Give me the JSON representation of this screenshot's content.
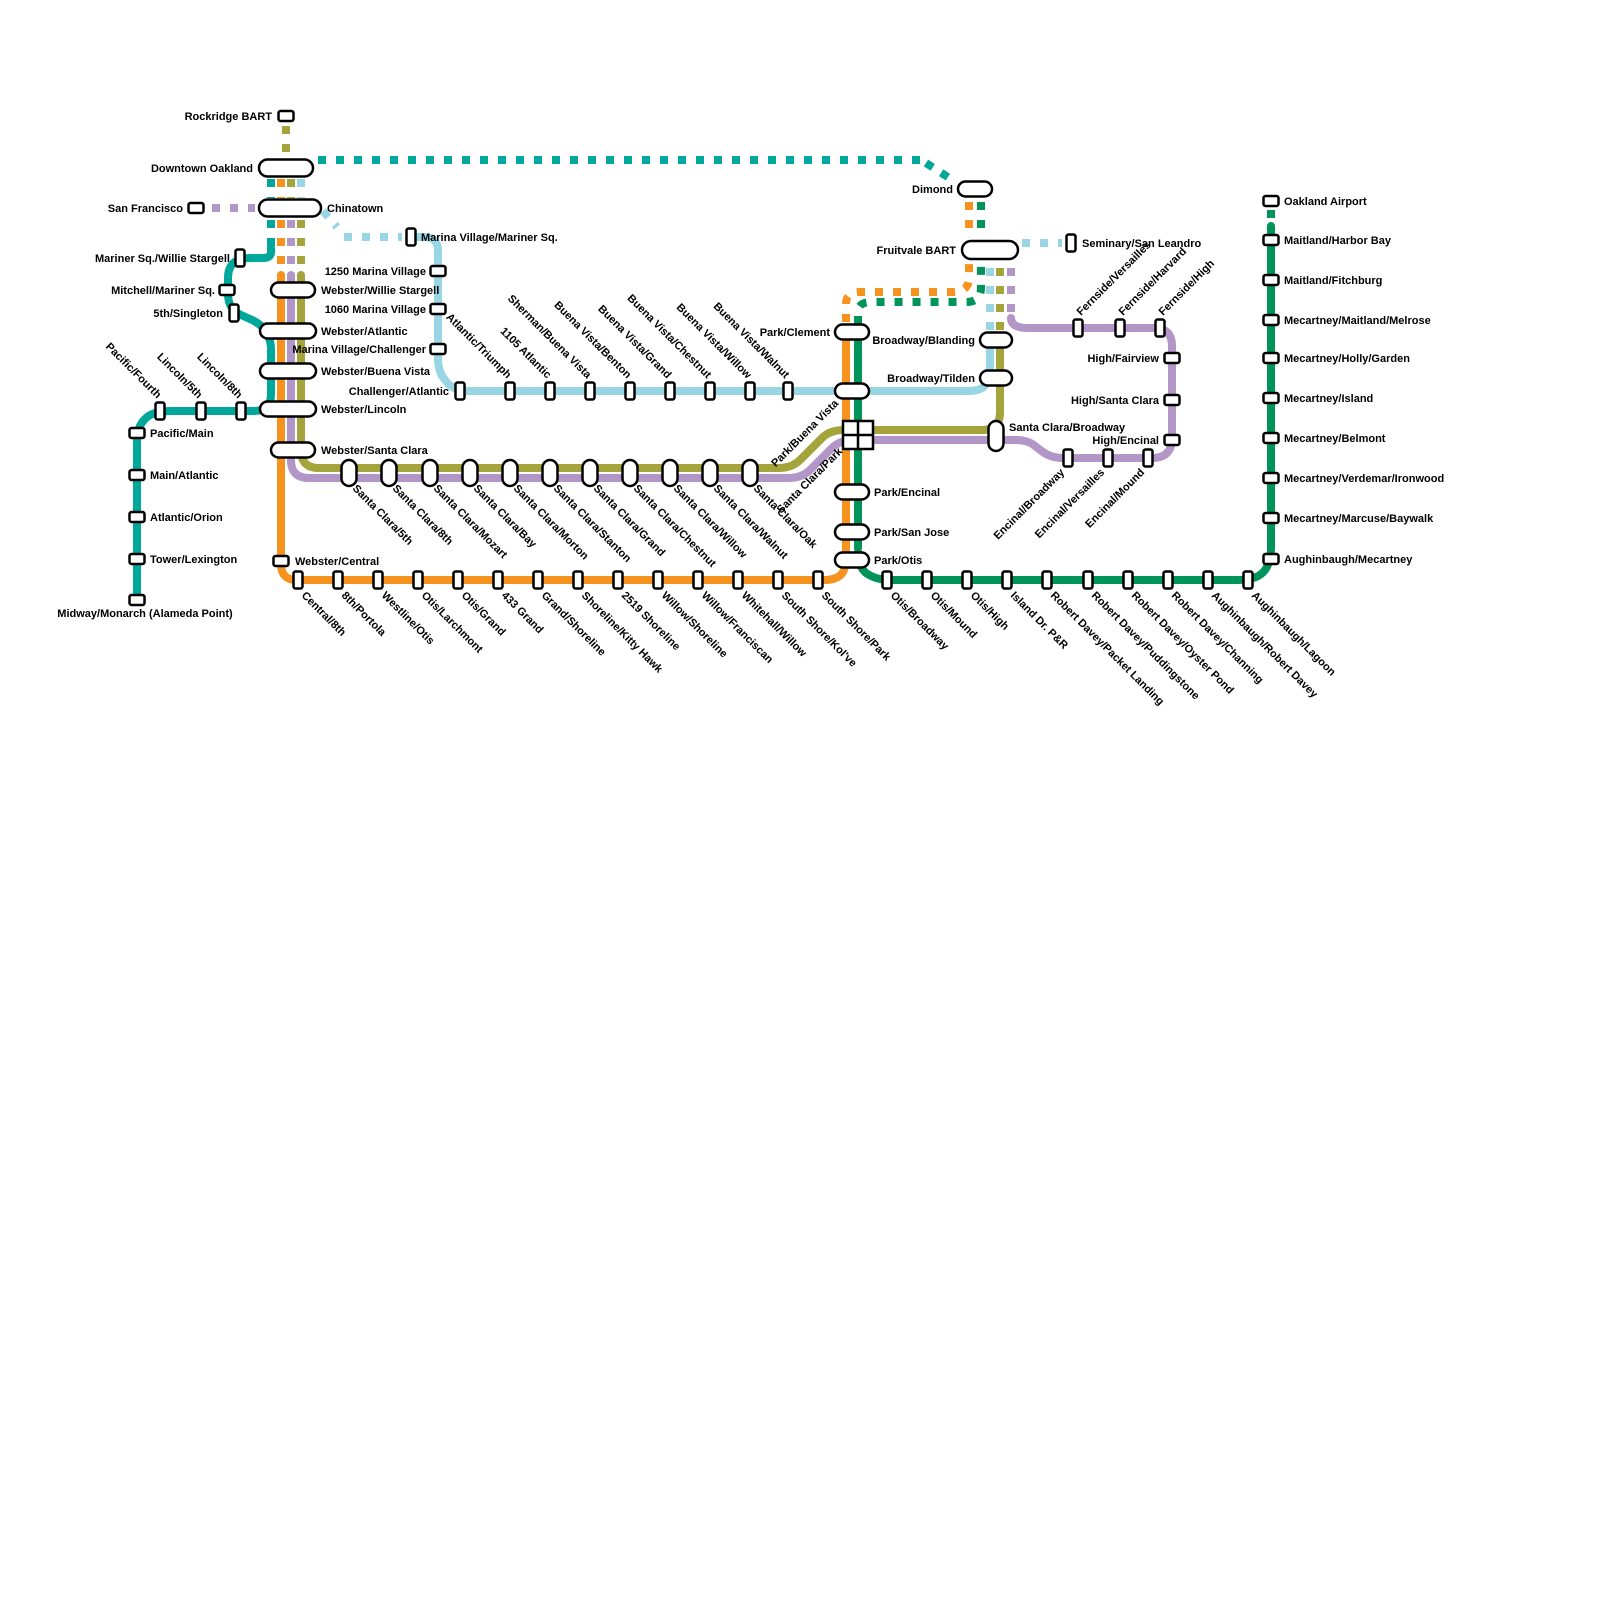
{
  "map": {
    "background": "#ffffff",
    "colors": {
      "teal": "#00a89c",
      "orange": "#f6921e",
      "lightblue": "#98d6e4",
      "olive": "#a4a33c",
      "purple": "#b296c7",
      "green": "#00945a"
    },
    "segments": [
      {
        "c": "teal",
        "d": false,
        "p": "M 271 248 V 252 Q 271 258 263 258 H 250 Q 228 258 228 278 V 294 Q 228 309 241 315 L 250 319 Q 271 328 271 350 V 394 Q 271 411 254 411 H 172 Q 152 411 145 419 Q 137 427 137 440 V 598"
      },
      {
        "c": "teal",
        "d": true,
        "p": "M 271 179 V 198"
      },
      {
        "c": "teal",
        "d": true,
        "p": "M 271 220 V 246"
      },
      {
        "c": "teal",
        "d": true,
        "p": "M 318 160 H 920"
      },
      {
        "c": "teal",
        "d": true,
        "p": "M 926 163 L 954 181"
      },
      {
        "c": "orange",
        "d": false,
        "p": "M 281 275 V 564 Q 281 580 297 580 H 824 Q 840 580 844 570 Q 846 564 846 548 V 330"
      },
      {
        "c": "orange",
        "d": true,
        "p": "M 281 179 V 198"
      },
      {
        "c": "orange",
        "d": true,
        "p": "M 281 220 V 276"
      },
      {
        "c": "orange",
        "d": true,
        "p": "M 846 322 V 304 Q 846 292 860 292 H 952 Q 969 292 969 278 V 262"
      },
      {
        "c": "orange",
        "d": true,
        "p": "M 969 202 V 236"
      },
      {
        "c": "green",
        "d": false,
        "p": "M 858 548 V 330"
      },
      {
        "c": "green",
        "d": false,
        "p": "M 858 552 Q 858 566 866 573 Q 876 580 890 580 H 1238 Q 1258 580 1265 570 Q 1271 562 1271 548 V 226"
      },
      {
        "c": "green",
        "d": true,
        "p": "M 858 324 V 312 Q 858 302 872 302 H 966 Q 981 302 981 288 V 262"
      },
      {
        "c": "green",
        "d": true,
        "p": "M 981 202 V 236"
      },
      {
        "c": "green",
        "d": true,
        "p": "M 1271 210 V 224"
      },
      {
        "c": "lightblue",
        "d": false,
        "p": "M 412 237 H 424 Q 438 237 438 251 V 358 Q 438 372 445 380 Q 453 391 467 391 H 968 Q 982 391 986 384 Q 990 378 990 368 V 336"
      },
      {
        "c": "lightblue",
        "d": true,
        "p": "M 990 330 V 262"
      },
      {
        "c": "lightblue",
        "d": true,
        "p": "M 1022 243 H 1062"
      },
      {
        "c": "lightblue",
        "d": true,
        "p": "M 301 179 V 198"
      },
      {
        "c": "lightblue",
        "d": true,
        "p": "M 323 211 L 337 227"
      },
      {
        "c": "lightblue",
        "d": true,
        "p": "M 344 237 H 402"
      },
      {
        "c": "olive",
        "d": false,
        "p": "M 301 275 V 450 Q 301 468 319 468 H 778 Q 792 468 800 460 L 822 438 Q 830 430 844 430 H 982 Q 1000 430 1000 412 V 336"
      },
      {
        "c": "olive",
        "d": true,
        "p": "M 1000 330 V 262"
      },
      {
        "c": "olive",
        "d": true,
        "p": "M 286 126 V 152"
      },
      {
        "c": "olive",
        "d": true,
        "p": "M 291 179 V 198"
      },
      {
        "c": "olive",
        "d": true,
        "p": "M 301 220 V 276"
      },
      {
        "c": "purple",
        "d": false,
        "p": "M 291 275 V 460 Q 291 478 309 478 H 788 Q 802 478 810 470 L 832 448 Q 840 440 854 440 H 1016 Q 1028 440 1035 446 L 1043 452 Q 1051 458 1064 458 H 1152 Q 1172 458 1172 438 V 346 Q 1172 328 1154 328 H 1028 Q 1011 328 1011 318"
      },
      {
        "c": "purple",
        "d": true,
        "p": "M 1011 312 V 262"
      },
      {
        "c": "purple",
        "d": true,
        "p": "M 212 208 H 255"
      },
      {
        "c": "purple",
        "d": true,
        "p": "M 291 220 V 276"
      }
    ],
    "stations": [
      {
        "label": "Rockridge BART",
        "x": 286,
        "y": 116,
        "m": "rh",
        "lp": "left",
        "ld": 14
      },
      {
        "label": "Downtown Oakland",
        "x": 286,
        "y": 168,
        "m": "ph",
        "w": 54,
        "h": 17,
        "lp": "left",
        "ld": 33
      },
      {
        "label": "San Francisco",
        "x": 196,
        "y": 208,
        "m": "rh",
        "lp": "left",
        "ld": 13
      },
      {
        "label": "Chinatown",
        "x": 290,
        "y": 208,
        "m": "ph",
        "w": 62,
        "h": 17,
        "lp": "right",
        "ld": 37
      },
      {
        "label": "Marina Village/Mariner Sq.",
        "x": 411,
        "y": 237,
        "m": "rv",
        "lp": "right",
        "ld": 10
      },
      {
        "label": "Mariner Sq./Willie Stargell",
        "x": 240,
        "y": 258,
        "m": "rv",
        "lp": "left",
        "ld": 10
      },
      {
        "label": "1250 Marina Village",
        "x": 438,
        "y": 271,
        "m": "rh",
        "lp": "left",
        "ld": 12
      },
      {
        "label": "Mitchell/Mariner Sq.",
        "x": 227,
        "y": 290,
        "m": "rh",
        "lp": "left",
        "ld": 12
      },
      {
        "label": "Webster/Willie Stargell",
        "x": 293,
        "y": 290,
        "m": "ph",
        "w": 44,
        "lp": "right",
        "ld": 28
      },
      {
        "label": "1060 Marina Village",
        "x": 438,
        "y": 309,
        "m": "rh",
        "lp": "left",
        "ld": 12
      },
      {
        "label": "5th/Singleton",
        "x": 234,
        "y": 313,
        "m": "rv",
        "lp": "left",
        "ld": 11
      },
      {
        "label": "Webster/Atlantic",
        "x": 288,
        "y": 331,
        "m": "ph",
        "w": 56,
        "lp": "right",
        "ld": 33
      },
      {
        "label": "Marina Village/Challenger",
        "x": 438,
        "y": 349,
        "m": "rh",
        "lp": "left",
        "ld": 12
      },
      {
        "label": "Webster/Buena Vista",
        "x": 288,
        "y": 371,
        "m": "ph",
        "w": 56,
        "lp": "right",
        "ld": 33
      },
      {
        "label": "Challenger/Atlantic",
        "x": 460,
        "y": 391,
        "m": "rv",
        "lp": "left",
        "ld": 11
      },
      {
        "label": "Webster/Lincoln",
        "x": 288,
        "y": 409,
        "m": "ph",
        "w": 56,
        "lp": "right",
        "ld": 33
      },
      {
        "label": "Pacific/Fourth",
        "x": 160,
        "y": 411,
        "m": "rv",
        "lp": "ul"
      },
      {
        "label": "Lincoln/5th",
        "x": 201,
        "y": 411,
        "m": "rv",
        "lp": "ul"
      },
      {
        "label": "Lincoln/8th",
        "x": 241,
        "y": 411,
        "m": "rv",
        "lp": "ul"
      },
      {
        "label": "Webster/Santa Clara",
        "x": 293,
        "y": 450,
        "m": "ph",
        "w": 44,
        "lp": "right",
        "ld": 28
      },
      {
        "label": "Pacific/Main",
        "x": 137,
        "y": 433,
        "m": "rh",
        "lp": "right",
        "ld": 13
      },
      {
        "label": "Main/Atlantic",
        "x": 137,
        "y": 475,
        "m": "rh",
        "lp": "right",
        "ld": 13
      },
      {
        "label": "Atlantic/Orion",
        "x": 137,
        "y": 517,
        "m": "rh",
        "lp": "right",
        "ld": 13
      },
      {
        "label": "Tower/Lexington",
        "x": 137,
        "y": 559,
        "m": "rh",
        "lp": "right",
        "ld": 13
      },
      {
        "label": "Midway/Monarch (Alameda Point)",
        "x": 137,
        "y": 600,
        "m": "rh",
        "lp": "below",
        "ld": 17,
        "lo": [
          8,
          0
        ]
      },
      {
        "label": "Atlantic/Triumph",
        "x": 510,
        "y": 391,
        "m": "rv",
        "lp": "ul"
      },
      {
        "label": "1105 Atlantic",
        "x": 550,
        "y": 391,
        "m": "rv",
        "lp": "ul"
      },
      {
        "label": "Sherman/Buena Vista",
        "x": 590,
        "y": 391,
        "m": "rv",
        "lp": "ul"
      },
      {
        "label": "Buena Vista/Benton",
        "x": 630,
        "y": 391,
        "m": "rv",
        "lp": "ul"
      },
      {
        "label": "Buena Vista/Grand",
        "x": 670,
        "y": 391,
        "m": "rv",
        "lp": "ul"
      },
      {
        "label": "Buena Vista/Chestnut",
        "x": 710,
        "y": 391,
        "m": "rv",
        "lp": "ul"
      },
      {
        "label": "Buena Vista/Willow",
        "x": 750,
        "y": 391,
        "m": "rv",
        "lp": "ul"
      },
      {
        "label": "Buena Vista/Walnut",
        "x": 788,
        "y": 391,
        "m": "rv",
        "lp": "ul"
      },
      {
        "label": "Park/Buena Vista",
        "x": 852,
        "y": 391,
        "m": "ph",
        "w": 34,
        "lp": "dl",
        "lo": [
          -10,
          -2
        ]
      },
      {
        "label": "Santa Clara/5th",
        "x": 349,
        "y": 473,
        "m": "pv",
        "lp": "dr"
      },
      {
        "label": "Santa Clara/8th",
        "x": 389,
        "y": 473,
        "m": "pv",
        "lp": "dr"
      },
      {
        "label": "Santa Clara/Mozart",
        "x": 430,
        "y": 473,
        "m": "pv",
        "lp": "dr"
      },
      {
        "label": "Santa Clara/Bay",
        "x": 470,
        "y": 473,
        "m": "pv",
        "lp": "dr"
      },
      {
        "label": "Santa Clara/Morton",
        "x": 510,
        "y": 473,
        "m": "pv",
        "lp": "dr"
      },
      {
        "label": "Santa Clara/Stanton",
        "x": 550,
        "y": 473,
        "m": "pv",
        "lp": "dr"
      },
      {
        "label": "Santa Clara/Grand",
        "x": 590,
        "y": 473,
        "m": "pv",
        "lp": "dr"
      },
      {
        "label": "Santa Clara/Chestnut",
        "x": 630,
        "y": 473,
        "m": "pv",
        "lp": "dr"
      },
      {
        "label": "Santa Clara/Willow",
        "x": 670,
        "y": 473,
        "m": "pv",
        "lp": "dr"
      },
      {
        "label": "Santa Clara/Walnut",
        "x": 710,
        "y": 473,
        "m": "pv",
        "lp": "dr"
      },
      {
        "label": "Santa Clara/Oak",
        "x": 750,
        "y": 473,
        "m": "pv",
        "lp": "dr"
      },
      {
        "label": "Santa Clara/Park",
        "x": 858,
        "y": 435,
        "m": "ix",
        "lp": "dl",
        "lo": [
          -12,
          2
        ]
      },
      {
        "label": "Park/Clement",
        "x": 852,
        "y": 332,
        "m": "ph",
        "w": 34,
        "lp": "left",
        "ld": 22
      },
      {
        "label": "Park/Encinal",
        "x": 852,
        "y": 492,
        "m": "ph",
        "w": 34,
        "lp": "right",
        "ld": 22
      },
      {
        "label": "Park/San Jose",
        "x": 852,
        "y": 532,
        "m": "ph",
        "w": 34,
        "lp": "right",
        "ld": 22
      },
      {
        "label": "Park/Otis",
        "x": 852,
        "y": 560,
        "m": "ph",
        "w": 34,
        "lp": "right",
        "ld": 22
      },
      {
        "label": "Webster/Central",
        "x": 281,
        "y": 561,
        "m": "rh",
        "lp": "right",
        "ld": 14
      },
      {
        "label": "Central/8th",
        "x": 298,
        "y": 580,
        "m": "rv",
        "lp": "dr"
      },
      {
        "label": "8th/Portola",
        "x": 338,
        "y": 580,
        "m": "rv",
        "lp": "dr"
      },
      {
        "label": "Westline/Otis",
        "x": 378,
        "y": 580,
        "m": "rv",
        "lp": "dr"
      },
      {
        "label": "Otis/Larchmont",
        "x": 418,
        "y": 580,
        "m": "rv",
        "lp": "dr"
      },
      {
        "label": "Otis/Grand",
        "x": 458,
        "y": 580,
        "m": "rv",
        "lp": "dr"
      },
      {
        "label": "433 Grand",
        "x": 498,
        "y": 580,
        "m": "rv",
        "lp": "dr"
      },
      {
        "label": "Grand/Shoreline",
        "x": 538,
        "y": 580,
        "m": "rv",
        "lp": "dr"
      },
      {
        "label": "Shoreline/Kitty Hawk",
        "x": 578,
        "y": 580,
        "m": "rv",
        "lp": "dr"
      },
      {
        "label": "2519 Shoreline",
        "x": 618,
        "y": 580,
        "m": "rv",
        "lp": "dr"
      },
      {
        "label": "Willow/Shoreline",
        "x": 658,
        "y": 580,
        "m": "rv",
        "lp": "dr"
      },
      {
        "label": "Willow/Franciscan",
        "x": 698,
        "y": 580,
        "m": "rv",
        "lp": "dr"
      },
      {
        "label": "Whitehall/Willow",
        "x": 738,
        "y": 580,
        "m": "rv",
        "lp": "dr"
      },
      {
        "label": "South Shore/Kol've",
        "x": 778,
        "y": 580,
        "m": "rv",
        "lp": "dr"
      },
      {
        "label": "South Shore/Park",
        "x": 818,
        "y": 580,
        "m": "rv",
        "lp": "dr"
      },
      {
        "label": "Dimond",
        "x": 975,
        "y": 189,
        "m": "ph",
        "w": 34,
        "lp": "left",
        "ld": 22
      },
      {
        "label": "Fruitvale BART",
        "x": 990,
        "y": 250,
        "m": "ph",
        "w": 56,
        "h": 18,
        "lp": "left",
        "ld": 34
      },
      {
        "label": "Seminary/San Leandro",
        "x": 1071,
        "y": 243,
        "m": "rv",
        "lp": "right",
        "ld": 11
      },
      {
        "label": "Broadway/Blanding",
        "x": 996,
        "y": 340,
        "m": "ph",
        "w": 32,
        "lp": "left",
        "ld": 21
      },
      {
        "label": "Broadway/Tilden",
        "x": 996,
        "y": 378,
        "m": "ph",
        "w": 32,
        "lp": "left",
        "ld": 21
      },
      {
        "label": "Santa Clara/Broadway",
        "x": 996,
        "y": 436,
        "m": "pv",
        "h": 30,
        "lp": "right",
        "ld": 13,
        "lo": [
          0,
          -9
        ]
      },
      {
        "label": "Fernside/Versailles",
        "x": 1078,
        "y": 328,
        "m": "rv",
        "lp": "ur"
      },
      {
        "label": "Fernside/Harvard",
        "x": 1120,
        "y": 328,
        "m": "rv",
        "lp": "ur"
      },
      {
        "label": "Fernside/High",
        "x": 1160,
        "y": 328,
        "m": "rv",
        "lp": "ur"
      },
      {
        "label": "High/Fairview",
        "x": 1172,
        "y": 358,
        "m": "rh",
        "lp": "left",
        "ld": 13
      },
      {
        "label": "High/Santa Clara",
        "x": 1172,
        "y": 400,
        "m": "rh",
        "lp": "left",
        "ld": 13
      },
      {
        "label": "High/Encinal",
        "x": 1172,
        "y": 440,
        "m": "rh",
        "lp": "left",
        "ld": 13
      },
      {
        "label": "Encinal/Broadway",
        "x": 1068,
        "y": 458,
        "m": "rv",
        "lp": "dl"
      },
      {
        "label": "Encinal/Versailles",
        "x": 1108,
        "y": 458,
        "m": "rv",
        "lp": "dl"
      },
      {
        "label": "Encinal/Mound",
        "x": 1148,
        "y": 458,
        "m": "rv",
        "lp": "dl"
      },
      {
        "label": "Otis/Broadway",
        "x": 887,
        "y": 580,
        "m": "rv",
        "lp": "dr"
      },
      {
        "label": "Otis/Mound",
        "x": 927,
        "y": 580,
        "m": "rv",
        "lp": "dr"
      },
      {
        "label": "Otis/High",
        "x": 967,
        "y": 580,
        "m": "rv",
        "lp": "dr"
      },
      {
        "label": "Island Dr. P&R",
        "x": 1007,
        "y": 580,
        "m": "rv",
        "lp": "dr"
      },
      {
        "label": "Robert Davey/Packet Landing",
        "x": 1047,
        "y": 580,
        "m": "rv",
        "lp": "dr"
      },
      {
        "label": "Robert Davey/Puddingstone",
        "x": 1088,
        "y": 580,
        "m": "rv",
        "lp": "dr"
      },
      {
        "label": "Robert Davey/Oyster Pond",
        "x": 1128,
        "y": 580,
        "m": "rv",
        "lp": "dr"
      },
      {
        "label": "Robert Davey/Channing",
        "x": 1168,
        "y": 580,
        "m": "rv",
        "lp": "dr"
      },
      {
        "label": "Aughinbaugh/Robert Davey",
        "x": 1208,
        "y": 580,
        "m": "rv",
        "lp": "dr"
      },
      {
        "label": "Aughinbaugh/Lagoon",
        "x": 1248,
        "y": 580,
        "m": "rv",
        "lp": "dr"
      },
      {
        "label": "Oakland Airport",
        "x": 1271,
        "y": 201,
        "m": "rh",
        "lp": "right",
        "ld": 13
      },
      {
        "label": "Maitland/Harbor Bay",
        "x": 1271,
        "y": 240,
        "m": "rh",
        "lp": "right",
        "ld": 13
      },
      {
        "label": "Maitland/Fitchburg",
        "x": 1271,
        "y": 280,
        "m": "rh",
        "lp": "right",
        "ld": 13
      },
      {
        "label": "Mecartney/Maitland/Melrose",
        "x": 1271,
        "y": 320,
        "m": "rh",
        "lp": "right",
        "ld": 13
      },
      {
        "label": "Mecartney/Holly/Garden",
        "x": 1271,
        "y": 358,
        "m": "rh",
        "lp": "right",
        "ld": 13
      },
      {
        "label": "Mecartney/Island",
        "x": 1271,
        "y": 398,
        "m": "rh",
        "lp": "right",
        "ld": 13
      },
      {
        "label": "Mecartney/Belmont",
        "x": 1271,
        "y": 438,
        "m": "rh",
        "lp": "right",
        "ld": 13
      },
      {
        "label": "Mecartney/Verdemar/Ironwood",
        "x": 1271,
        "y": 478,
        "m": "rh",
        "lp": "right",
        "ld": 13
      },
      {
        "label": "Mecartney/Marcuse/Baywalk",
        "x": 1271,
        "y": 518,
        "m": "rh",
        "lp": "right",
        "ld": 13
      },
      {
        "label": "Aughinbaugh/Mecartney",
        "x": 1271,
        "y": 559,
        "m": "rh",
        "lp": "right",
        "ld": 13
      }
    ]
  }
}
